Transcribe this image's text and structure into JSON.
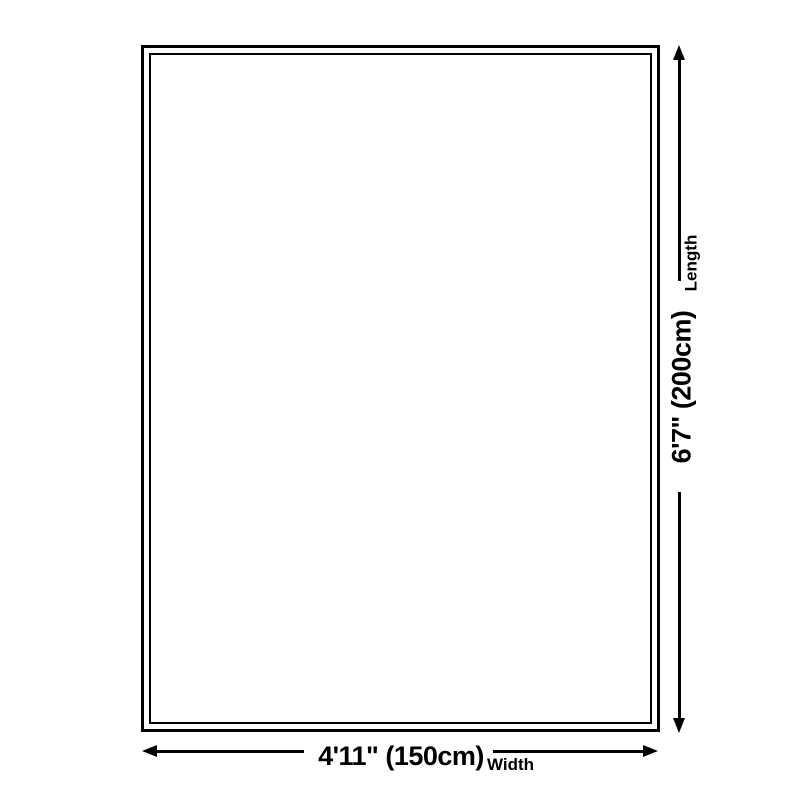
{
  "diagram": {
    "type": "product-size-diagram",
    "colors": {
      "background": "#ffffff",
      "line": "#000000",
      "text": "#000000"
    },
    "length": {
      "value": "6'7\" (200cm)",
      "label": "Length"
    },
    "width": {
      "value": "4'11\" (150cm)",
      "label": "Width"
    }
  }
}
